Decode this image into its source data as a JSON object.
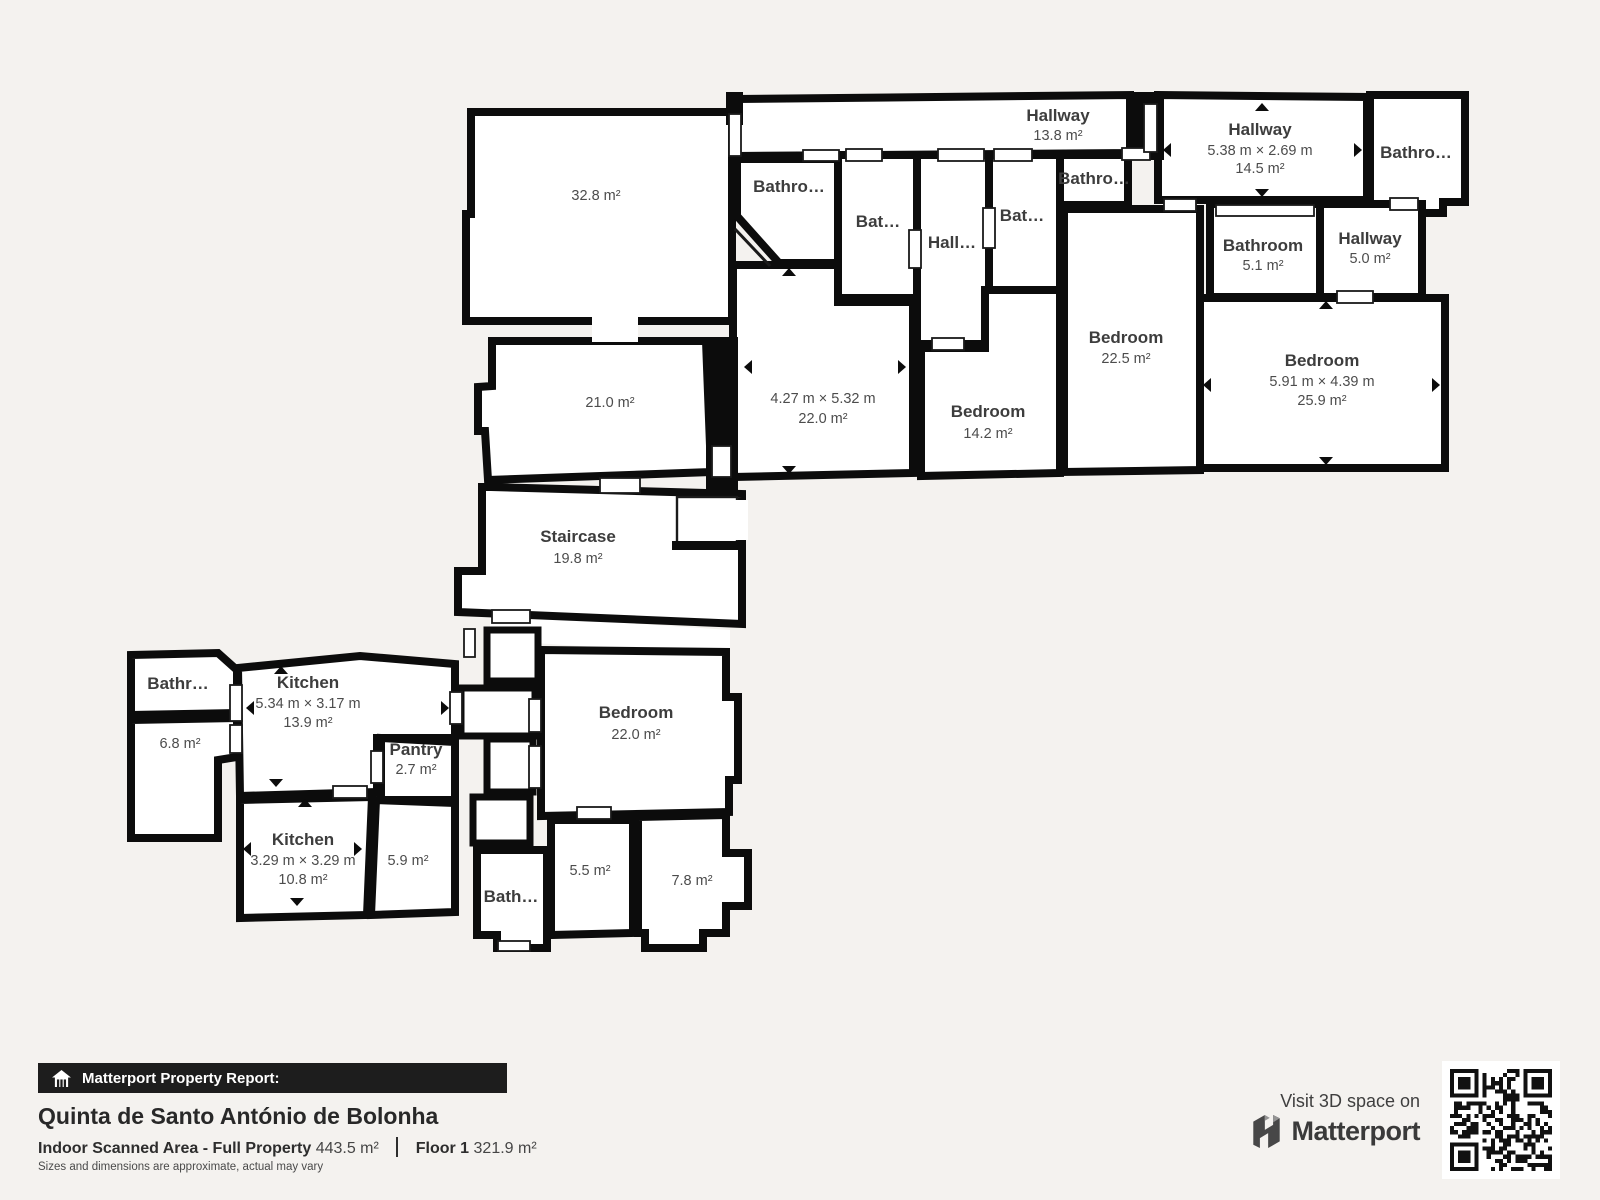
{
  "colors": {
    "background": "#f4f2ef",
    "wall": "#0c0c0c",
    "room_fill": "#ffffff",
    "name_text": "#3d3d3d",
    "value_text": "#4c4c4c",
    "banner_bg": "#1d1d1d"
  },
  "rooms": {
    "room_32": {
      "area": "32.8 m²"
    },
    "room_21": {
      "area": "21.0 m²"
    },
    "staircase": {
      "name": "Staircase",
      "area": "19.8 m²"
    },
    "hallway_top": {
      "name": "Hallway",
      "area": "13.8 m²"
    },
    "bathroom_a": {
      "name": "Bathro…"
    },
    "bathroom_b": {
      "name": "Bat…"
    },
    "hallway_mid": {
      "name": "Hall…"
    },
    "bathroom_c": {
      "name": "Bat…"
    },
    "bathroom_d": {
      "name": "Bathro…"
    },
    "hallway_14": {
      "name": "Hallway",
      "dims": "5.38 m × 2.69 m",
      "area": "14.5 m²"
    },
    "bathroom_tr": {
      "name": "Bathro…"
    },
    "bathroom_51": {
      "name": "Bathroom",
      "area": "5.1 m²"
    },
    "hallway_50": {
      "name": "Hallway",
      "area": "5.0 m²"
    },
    "room_22": {
      "dims": "4.27 m × 5.32 m",
      "area": "22.0 m²"
    },
    "bedroom_142": {
      "name": "Bedroom",
      "area": "14.2 m²"
    },
    "bedroom_225": {
      "name": "Bedroom",
      "area": "22.5 m²"
    },
    "bedroom_259": {
      "name": "Bedroom",
      "dims": "5.91 m × 4.39 m",
      "area": "25.9 m²"
    },
    "bathroom_k": {
      "name": "Bathr…"
    },
    "room_68": {
      "area": "6.8 m²"
    },
    "kitchen_139": {
      "name": "Kitchen",
      "dims": "5.34 m × 3.17 m",
      "area": "13.9 m²"
    },
    "pantry": {
      "name": "Pantry",
      "area": "2.7 m²"
    },
    "kitchen_108": {
      "name": "Kitchen",
      "dims": "3.29 m × 3.29 m",
      "area": "10.8 m²"
    },
    "room_59": {
      "area": "5.9 m²"
    },
    "bedroom_22": {
      "name": "Bedroom",
      "area": "22.0 m²"
    },
    "room_55": {
      "area": "5.5 m²"
    },
    "room_78": {
      "area": "7.8 m²"
    },
    "bathroom_s": {
      "name": "Bath…"
    }
  },
  "footer": {
    "report_label": "Matterport Property Report:",
    "property_name": "Quinta de Santo António de Bolonha",
    "scanned_label": "Indoor Scanned Area - Full Property",
    "scanned_value": "443.5 m²",
    "floor_label": "Floor 1",
    "floor_value": "321.9 m²",
    "disclaimer": "Sizes and dimensions are approximate, actual may vary"
  },
  "promo": {
    "visit_label": "Visit 3D space on",
    "brand_name": "Matterport"
  }
}
